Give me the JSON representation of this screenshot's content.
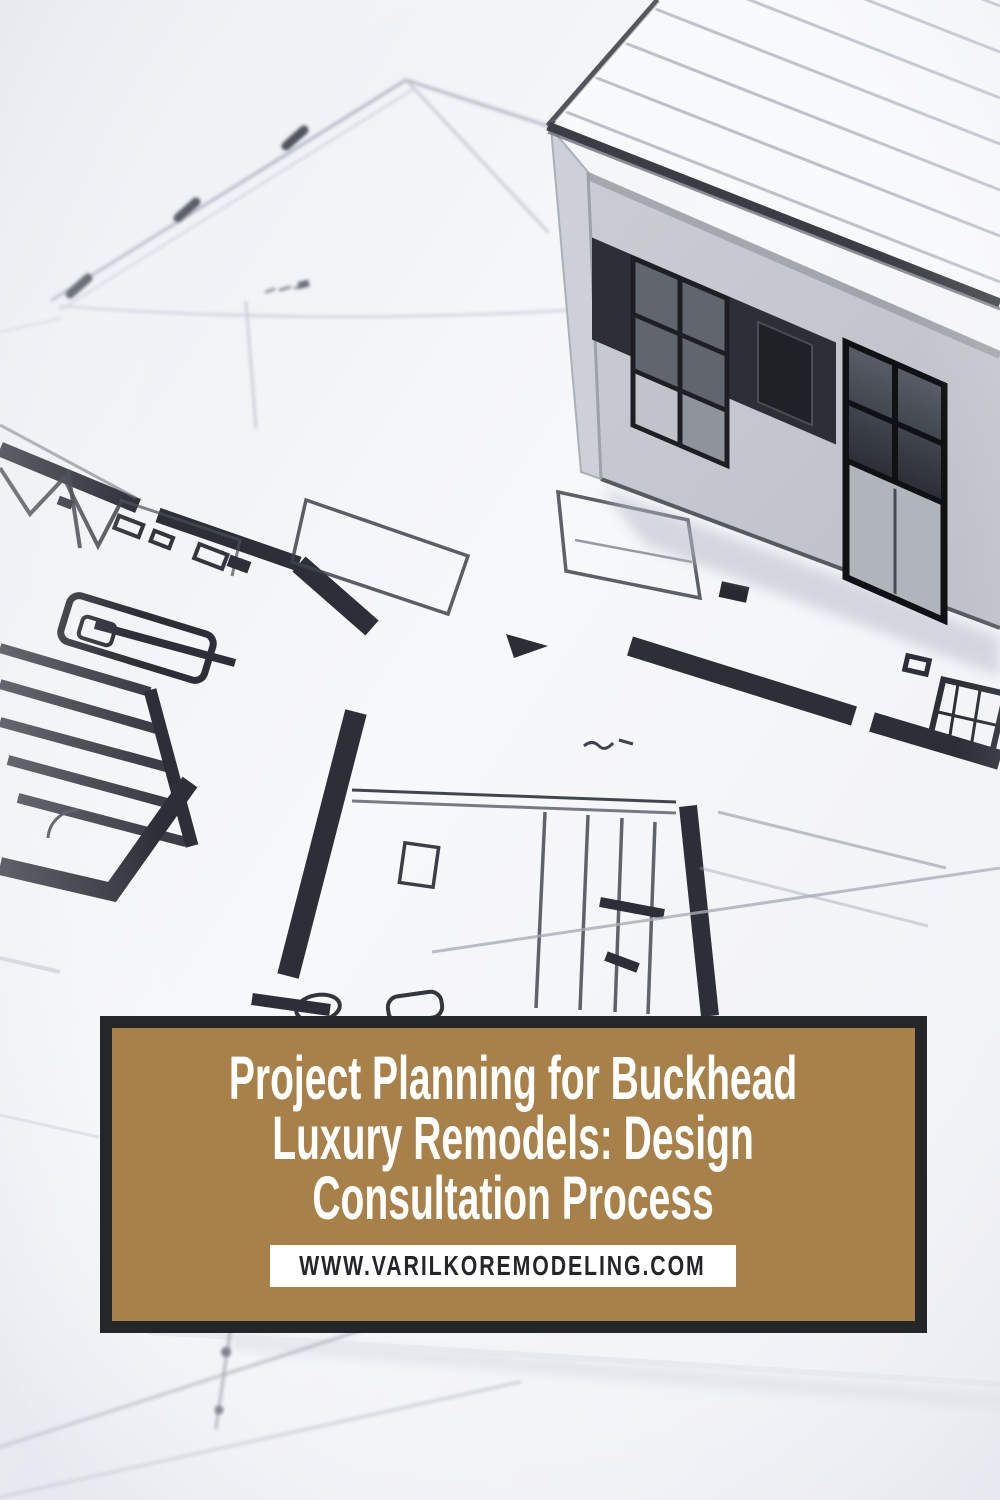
{
  "banner": {
    "title_lines": [
      "Project Planning for Buckhead",
      "Luxury Remodels: Design",
      "Consultation Process"
    ],
    "website": "WWW.VARILKOREMODELING.COM",
    "colors": {
      "banner_background": "#a8814a",
      "banner_frame": "#25262a",
      "title_text": "#ffffff",
      "website_background": "#ffffff",
      "website_text": "#26262a"
    }
  },
  "photo": {
    "description": "White architectural model house standing on hand-sketched floor plan blueprints"
  }
}
